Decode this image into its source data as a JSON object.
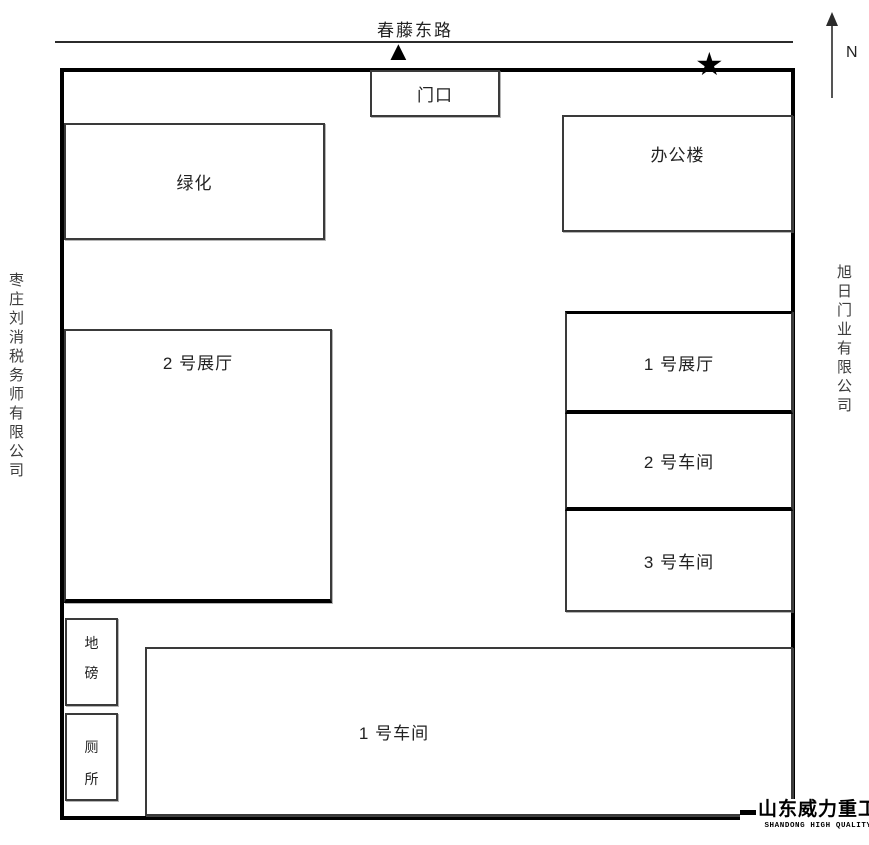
{
  "road": {
    "name": "春藤东路"
  },
  "compass": {
    "label": "N"
  },
  "markers": {
    "entrance_triangle": "▲",
    "star": "★"
  },
  "site": {
    "gate": "门口",
    "greenery": "绿化",
    "office": "办公楼",
    "hall2": "2 号展厅",
    "hall1": "1 号展厅",
    "workshop2": "2 号车间",
    "workshop3": "3 号车间",
    "workshop1": "1 号车间",
    "weighbridge": [
      "地",
      "磅"
    ],
    "toilet": [
      "厕",
      "所"
    ]
  },
  "neighbors": {
    "west": "枣庄刘消税务师有限公司",
    "east": "旭日门业有限公司"
  },
  "logo": {
    "cn": "山东威力重工",
    "en": "SHANDONG HIGH QUALITY"
  },
  "colors": {
    "line": "#000000",
    "thin_border": "#3a3a3a",
    "text": "#222222",
    "background": "#ffffff"
  }
}
